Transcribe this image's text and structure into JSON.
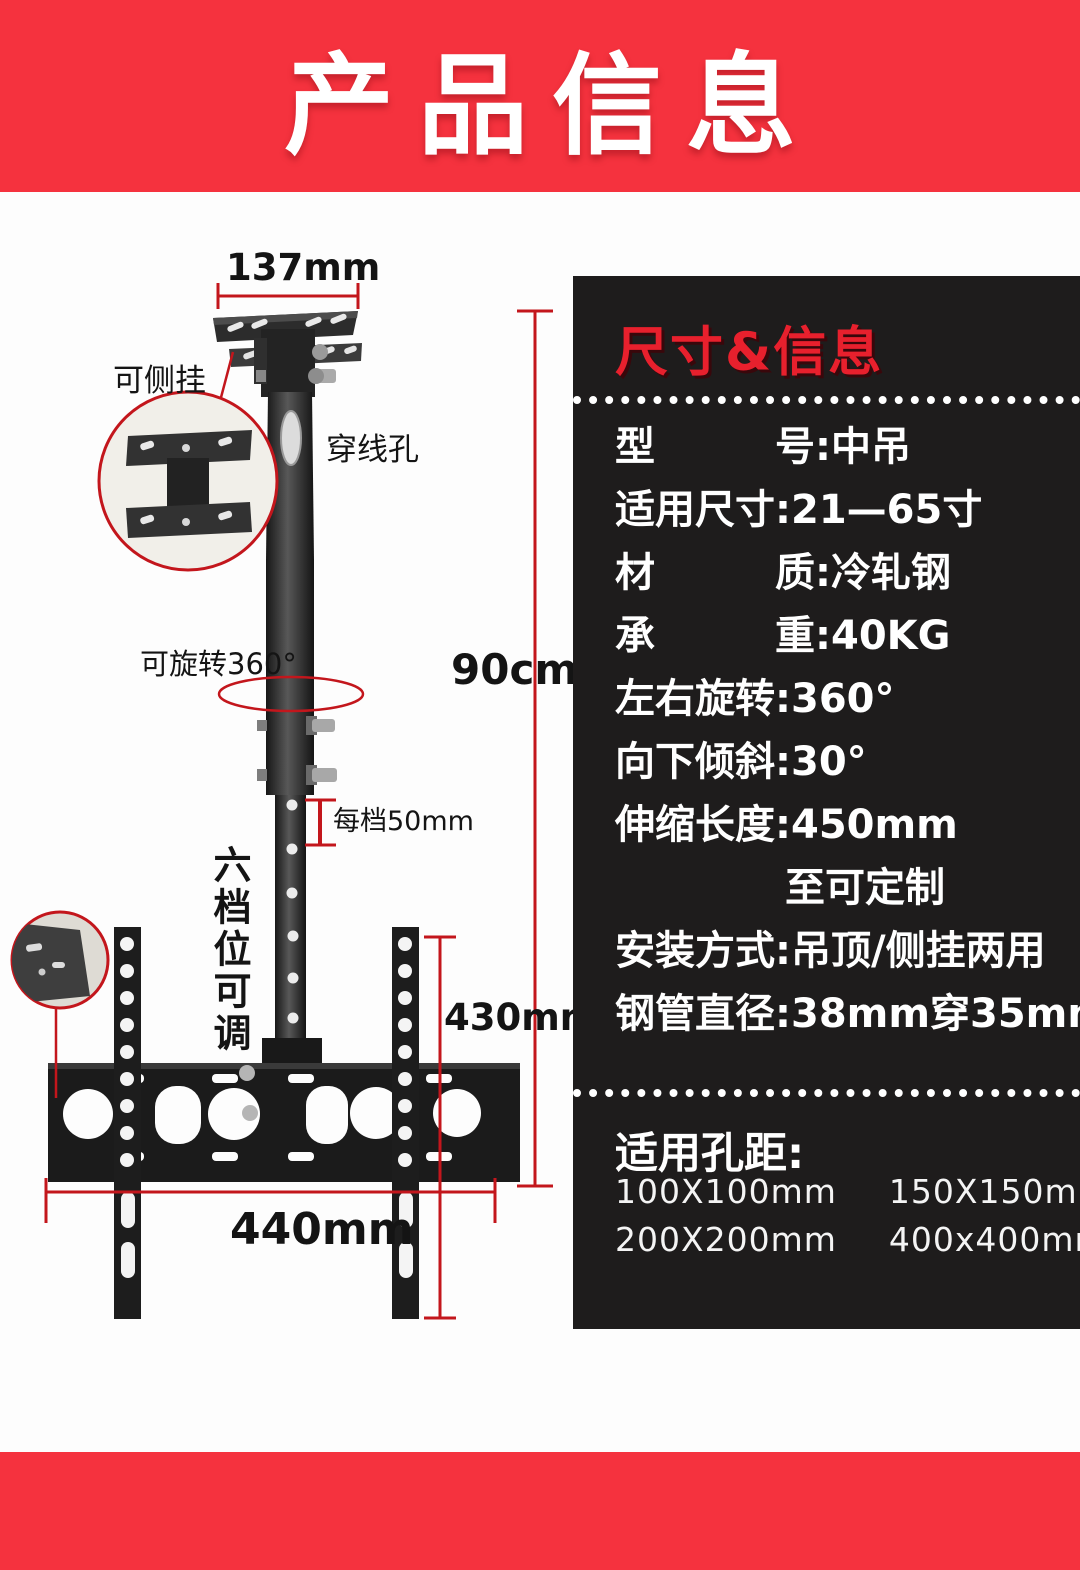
{
  "page": {
    "bg": "#fdfdfd",
    "accent_red": "#f5323e",
    "dimension_red": "#c3161c",
    "panel_bg": "#1e1c1c"
  },
  "header": {
    "title": "产品信息"
  },
  "diagram": {
    "top_width_label": "137mm",
    "side_mount_label": "可侧挂",
    "cable_hole_label": "穿线孔",
    "rotate_label": "可旋转360°",
    "drop_height_label": "90cm",
    "step_label": "每档50mm",
    "adjustable_label": "六档位可调",
    "bracket_height_label": "430mm",
    "bracket_width_label": "440mm"
  },
  "panel": {
    "title": "尺寸&信息",
    "specs": [
      "型　　　号:中吊",
      "适用尺寸:21—65寸",
      "材　　　质:冷轧钢",
      "承　　　重:40KG",
      "左右旋转:360°",
      "向下倾斜:30°",
      "伸缩长度:450mm",
      "至可定制",
      "安装方式:吊顶/侧挂两用",
      "钢管直径:38mm穿35mm"
    ],
    "holes": {
      "heading": "适用孔距:",
      "row1": [
        "100X100mm",
        "150X150mm"
      ],
      "row2": [
        "200X200mm",
        "400x400mm"
      ]
    }
  }
}
